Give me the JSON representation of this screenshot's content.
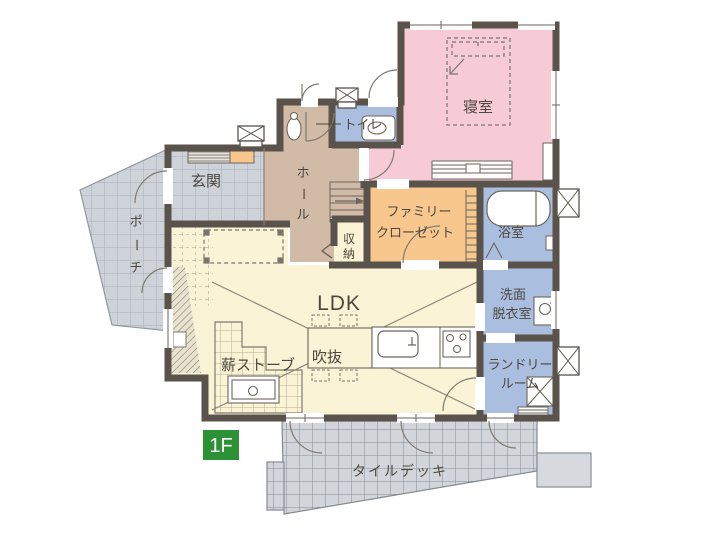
{
  "floor_plan": {
    "floor_badge": "1F",
    "labels": {
      "bedroom": "寝室",
      "toilet": "トイレ",
      "entrance": "玄関",
      "porch": "ポーチ",
      "hall": "ホール",
      "family_closet_line1": "ファミリー",
      "family_closet_line2": "クローゼット",
      "bath": "浴室",
      "storage": "収納",
      "ldk": "LDK",
      "void": "吹抜",
      "wood_stove": "薪ストーブ",
      "washroom_line1": "洗面",
      "washroom_line2": "脱衣室",
      "laundry_line1": "ランドリー",
      "laundry_line2": "ルーム",
      "tile_deck": "タイルデッキ"
    },
    "colors": {
      "wall": "#59534b",
      "bedroom": "#f7cbd6",
      "water_rooms": "#aabfdf",
      "closet": "#f7c78e",
      "hall": "#d2bba6",
      "ldk": "#fbf3d6",
      "tile": "#ced2d9",
      "badge_green": "#2d9135"
    }
  }
}
